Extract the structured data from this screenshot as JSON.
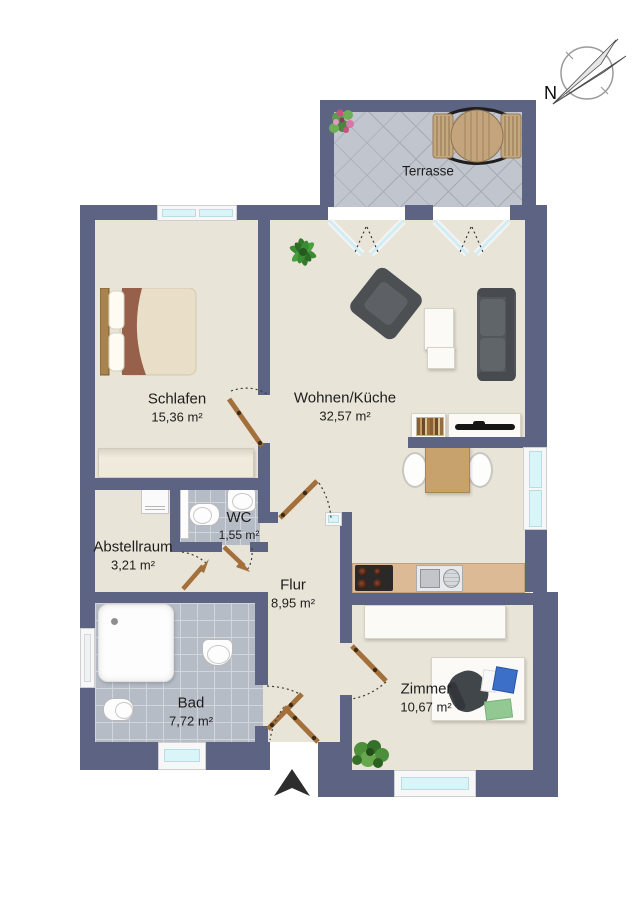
{
  "plan_type": "floor-plan",
  "compass": {
    "label": "N"
  },
  "outdoor": {
    "terrace": {
      "name": "Terrasse"
    }
  },
  "rooms": {
    "schlafen": {
      "name": "Schlafen",
      "area": "15,36 m²"
    },
    "wohnen_kueche": {
      "name": "Wohnen/Küche",
      "area": "32,57 m²"
    },
    "wc": {
      "name": "WC",
      "area": "1,55 m²"
    },
    "abstellraum": {
      "name": "Abstellraum",
      "area": "3,21 m²"
    },
    "flur": {
      "name": "Flur",
      "area": "8,95 m²"
    },
    "bad": {
      "name": "Bad",
      "area": "7,72 m²"
    },
    "zimmer": {
      "name": "Zimmer",
      "area": "10,67 m²"
    }
  },
  "colors": {
    "wall": "#5d6382",
    "floor": "#e9e4d8",
    "tile": "#b6bcc6",
    "glass": "#d9f5f8",
    "door": "#a3703c",
    "counter": "#dcba95"
  }
}
